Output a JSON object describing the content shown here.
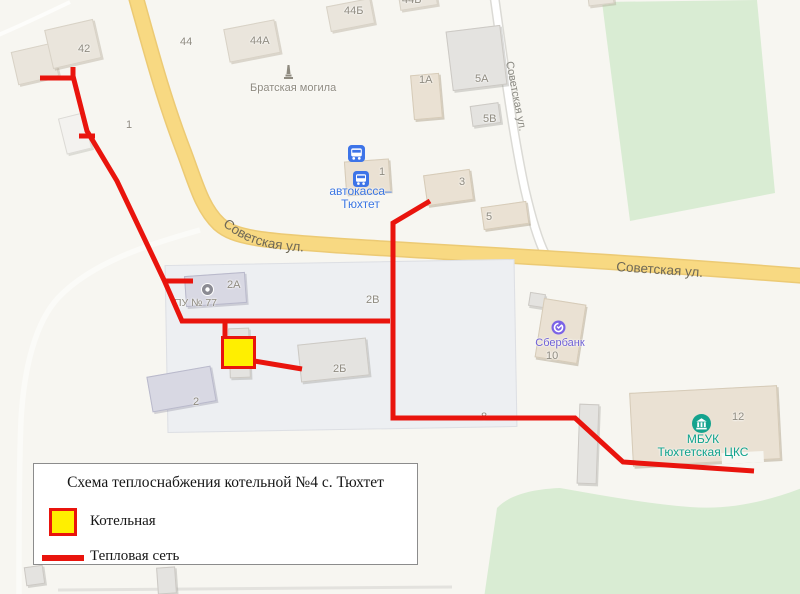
{
  "legend": {
    "title": "Схема теплоснабжения котельной №4 с. Тюхтет",
    "boiler_label": "Котельная",
    "network_label": "Тепловая сеть"
  },
  "streets": {
    "sovetskaya_curved": "Советская ул.",
    "sovetskaya_right": "Советская ул.",
    "sovetskaya_side": "Советская ул."
  },
  "building_numbers": {
    "b42": "42",
    "b44": "44",
    "b44a": "44А",
    "b44b": "44Б",
    "b44b_top": "44Б",
    "b1a": "1А",
    "b5a": "5А",
    "b5v": "5В",
    "b1_area": "1",
    "b1_kassa": "1",
    "b3": "3",
    "b5": "5",
    "b2a": "2А",
    "b2v": "2В",
    "b2b": "2Б",
    "b2": "2",
    "b8": "8",
    "b10": "10",
    "b12": "12"
  },
  "pois": {
    "memorial": "Братская могила",
    "bus_office_line1": "автокасса–",
    "bus_office_line2": "Тюхтет",
    "pu77": "ПУ № 77",
    "sberbank": "Сбербанк",
    "mbuk_line1": "МБУК",
    "mbuk_line2": "Тюхтетская ЦКС"
  },
  "colors": {
    "heat_network": "#e9140d",
    "boiler_fill": "#ffef00",
    "road_main": "#f8d982",
    "green_area": "#d9ecd3",
    "poi_blue": "#3b76e2",
    "poi_violet": "#6f61d6",
    "poi_teal": "#0fa28c"
  }
}
